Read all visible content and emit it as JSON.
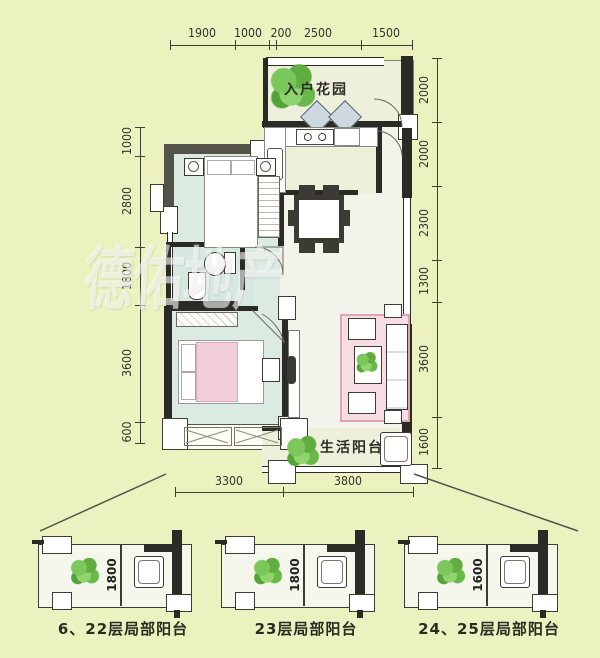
{
  "watermark": "德佑地产",
  "plan": {
    "entry_garden_label": "入户花园",
    "living_balcony_label": "生活阳台"
  },
  "dims": {
    "top": [
      "1900",
      "1000",
      "200",
      "2500",
      "1500"
    ],
    "bottom": [
      "3300",
      "3800"
    ],
    "left": [
      "1000",
      "2800",
      "1800",
      "3600",
      "600"
    ],
    "right": [
      "2000",
      "2000",
      "2300",
      "1300",
      "3600",
      "1600"
    ]
  },
  "mini_diagrams": [
    {
      "dim": "1800",
      "caption": "6、22层局部阳台"
    },
    {
      "dim": "1800",
      "caption": "23层局部阳台"
    },
    {
      "dim": "1600",
      "caption": "24、25层局部阳台"
    }
  ],
  "colors": {
    "background": "#ecf2bf",
    "wall": "#2b2b26",
    "bedroom_floor": "#dcebe2",
    "kitchen_floor": "#eef0d9",
    "living_floor": "#f3f3ec",
    "accent_pink": "#f2cfd8",
    "plant_green": "#6fbf4e",
    "dim_text": "#33342c"
  }
}
